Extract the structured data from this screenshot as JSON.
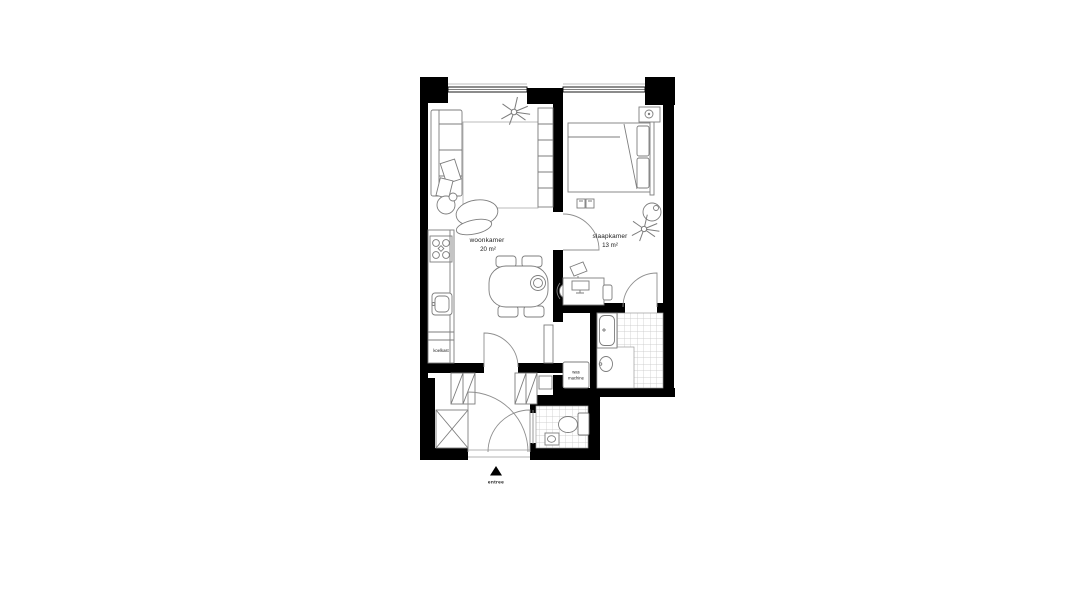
{
  "floorplan": {
    "rooms": {
      "living": {
        "name": "woonkamer",
        "area": "20 m²"
      },
      "bedroom": {
        "name": "slaapkamer",
        "area": "13 m²"
      }
    },
    "appliances": {
      "fridge": "koelkast",
      "washer_line1": "was",
      "washer_line2": "machine"
    },
    "entrance": {
      "label": "entree",
      "marker": "up-triangle"
    },
    "colors": {
      "walls": "#000000",
      "furniture_lines": "#7d7d7d",
      "tiles": "#c4c4c4",
      "background": "#ffffff",
      "text": "#1a1a1a"
    }
  }
}
